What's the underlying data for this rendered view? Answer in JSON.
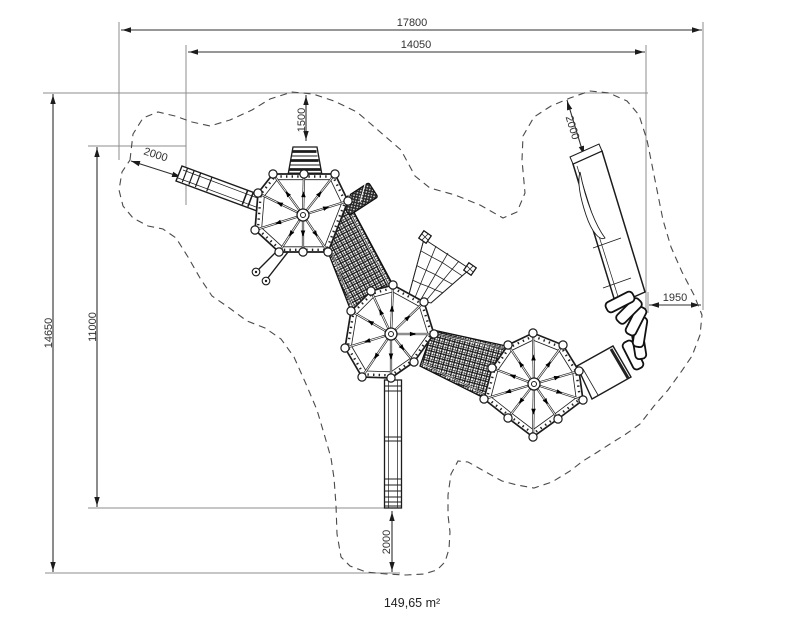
{
  "drawing": {
    "type": "playground equipment plan view with safety-zone dimensions",
    "area_label": "149,65 m²",
    "dimensions": {
      "overall_width": "17800",
      "inner_width": "14050",
      "overall_height": "14650",
      "inner_height": "11000",
      "top_ramp_offset": "1500",
      "left_slide_offset": "2000",
      "right_slide_offset": "2000",
      "right_side_offset": "1950",
      "bottom_slide_offset": "2000"
    },
    "colors": {
      "line": "#1c1c1c",
      "dimension": "#2f2f2f",
      "extension": "#8d8d8d",
      "boundary": "#4a4a4a",
      "background": "#ffffff"
    }
  }
}
